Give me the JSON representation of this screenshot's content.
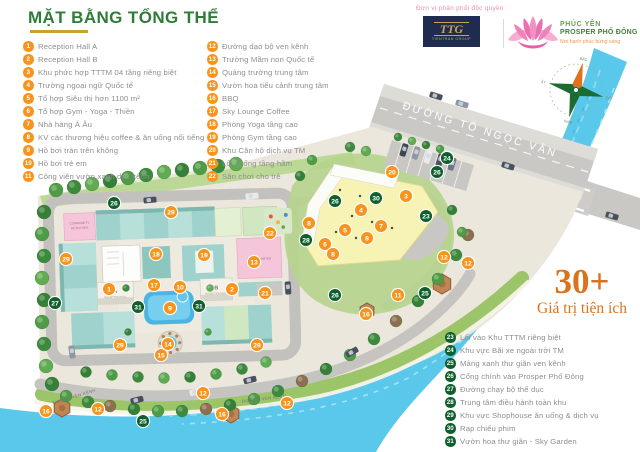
{
  "title": {
    "text": "MẶT BẰNG TỔNG THỂ"
  },
  "colors": {
    "title_green": "#2f7c38",
    "gold": "#c9a22e",
    "badge_orange": "#f7941e",
    "badge_green": "#0e5f2c",
    "legend_text": "#8e8e8e",
    "river": "#5ac8ea",
    "road": "#c9c8c4",
    "platform": "#ebe7dc",
    "highlight_orange": "#d9731c"
  },
  "legend": {
    "group1": [
      {
        "n": "1",
        "label": "Reception Hall  A"
      },
      {
        "n": "2",
        "label": "Reception Hall B"
      },
      {
        "n": "3",
        "label": "Khu phức hợp TTTM 04 tầng riêng biệt"
      },
      {
        "n": "4",
        "label": "Trường ngoại ngữ Quốc tế"
      },
      {
        "n": "5",
        "label": "Tổ hợp Siêu thị hơn 1100 m²"
      },
      {
        "n": "6",
        "label": "Tổ hợp Gym - Yoga - Thiền"
      },
      {
        "n": "7",
        "label": "Nhà hàng Á Âu"
      },
      {
        "n": "8",
        "label": "KV các thương hiệu coffee & ăn uống nổi tiếng"
      },
      {
        "n": "9",
        "label": "Hồ bơi tràn trên không"
      },
      {
        "n": "10",
        "label": "Hồ bơi trẻ em"
      },
      {
        "n": "11",
        "label": "Công viên vườn xanh dọc kênh"
      }
    ],
    "group2": [
      {
        "n": "12",
        "label": "Đường dạo bộ ven kênh"
      },
      {
        "n": "13",
        "label": "Trường Mầm non Quốc tế"
      },
      {
        "n": "14",
        "label": "Quảng trường trung tâm"
      },
      {
        "n": "15",
        "label": "Vườn hoa tiểu cảnh trung tâm"
      },
      {
        "n": "16",
        "label": "BBQ"
      },
      {
        "n": "17",
        "label": "Sky Lounge Coffee"
      },
      {
        "n": "18",
        "label": "Phòng Yoga tầng cao"
      },
      {
        "n": "19",
        "label": "Phòng Gym tầng cao"
      },
      {
        "n": "20",
        "label": "Khu Căn hộ dịch vụ TM"
      },
      {
        "n": "21",
        "label": "Lối xuống tầng hầm"
      },
      {
        "n": "22",
        "label": "Sân chơi cho trẻ"
      }
    ],
    "group3": [
      {
        "n": "23",
        "label": "Lối vào Khu TTTM riêng biệt"
      },
      {
        "n": "24",
        "label": "Khu vực Bãi xe ngoài trời TM"
      },
      {
        "n": "25",
        "label": "Mảng xanh thư giãn ven kênh"
      },
      {
        "n": "26",
        "label": "Cổng chính vào Prosper Phố Đông"
      },
      {
        "n": "27",
        "label": "Đường chạy bộ thể dục"
      },
      {
        "n": "28",
        "label": "Trung tâm điều hành toàn khu"
      },
      {
        "n": "29",
        "label": "Khu vực Shophouse ăn uống & dịch vụ"
      },
      {
        "n": "30",
        "label": "Rạp chiếu phim"
      },
      {
        "n": "31",
        "label": "Vườn hoa thư giãn - Sky Garden"
      }
    ]
  },
  "distributor": {
    "heading": "Đơn vị phân phối độc quyền",
    "ttg_monogram": "TTG",
    "ttg_name": "TIENTRAN GROUP",
    "brand_line1": "PHÚC YÊN",
    "brand_line2": "PROSPER PHỐ ĐÔNG",
    "brand_tagline": "Nơi hạnh phúc bừng sáng"
  },
  "highlight": {
    "big": "30+",
    "sub": "Giá trị tiện ích"
  },
  "compass": {
    "north": "BẮC",
    "east": "ĐÔNG",
    "south": "NAM",
    "west": "TÂY"
  },
  "map": {
    "road_main": "ĐƯỜNG TÔ NGỌC VÂN",
    "road_canal": "ĐƯỜNG VEN KÊNH",
    "labels": {
      "community_1": "COMMUNITY",
      "community_2": "ACTIVITIES",
      "kindergarten": "KINDERGARTEN",
      "reception_a": "A",
      "reception_a_sub": "RECEPTION HALL",
      "reception_b": "B",
      "reception_b_sub": "RECEPTION HALL"
    },
    "markers": [
      {
        "n": "26",
        "x": 114,
        "y": 203,
        "c": "g"
      },
      {
        "n": "29",
        "x": 171,
        "y": 212,
        "c": "o"
      },
      {
        "n": "18",
        "x": 156,
        "y": 254,
        "c": "o"
      },
      {
        "n": "19",
        "x": 204,
        "y": 255,
        "c": "o"
      },
      {
        "n": "13",
        "x": 254,
        "y": 262,
        "c": "o"
      },
      {
        "n": "22",
        "x": 270,
        "y": 233,
        "c": "o"
      },
      {
        "n": "8",
        "x": 309,
        "y": 223,
        "c": "o"
      },
      {
        "n": "28",
        "x": 306,
        "y": 240,
        "c": "g"
      },
      {
        "n": "29",
        "x": 66,
        "y": 259,
        "c": "o"
      },
      {
        "n": "27",
        "x": 55,
        "y": 303,
        "c": "g"
      },
      {
        "n": "1",
        "x": 109,
        "y": 289,
        "c": "o"
      },
      {
        "n": "17",
        "x": 154,
        "y": 285,
        "c": "o"
      },
      {
        "n": "10",
        "x": 180,
        "y": 287,
        "c": "o"
      },
      {
        "n": "2",
        "x": 232,
        "y": 289,
        "c": "o"
      },
      {
        "n": "21",
        "x": 265,
        "y": 293,
        "c": "o"
      },
      {
        "n": "31",
        "x": 138,
        "y": 307,
        "c": "g"
      },
      {
        "n": "9",
        "x": 170,
        "y": 308,
        "c": "o"
      },
      {
        "n": "31",
        "x": 199,
        "y": 306,
        "c": "g"
      },
      {
        "n": "14",
        "x": 168,
        "y": 344,
        "c": "o"
      },
      {
        "n": "15",
        "x": 161,
        "y": 355,
        "c": "o"
      },
      {
        "n": "29",
        "x": 120,
        "y": 345,
        "c": "o"
      },
      {
        "n": "29",
        "x": 257,
        "y": 345,
        "c": "o"
      },
      {
        "n": "24",
        "x": 447,
        "y": 158,
        "c": "g"
      },
      {
        "n": "26",
        "x": 437,
        "y": 172,
        "c": "g"
      },
      {
        "n": "20",
        "x": 392,
        "y": 172,
        "c": "o"
      },
      {
        "n": "30",
        "x": 376,
        "y": 198,
        "c": "g"
      },
      {
        "n": "3",
        "x": 406,
        "y": 196,
        "c": "o"
      },
      {
        "n": "4",
        "x": 361,
        "y": 210,
        "c": "o"
      },
      {
        "n": "23",
        "x": 426,
        "y": 216,
        "c": "g"
      },
      {
        "n": "26",
        "x": 335,
        "y": 201,
        "c": "g"
      },
      {
        "n": "5",
        "x": 345,
        "y": 230,
        "c": "o"
      },
      {
        "n": "7",
        "x": 381,
        "y": 226,
        "c": "o"
      },
      {
        "n": "8",
        "x": 367,
        "y": 238,
        "c": "o"
      },
      {
        "n": "6",
        "x": 325,
        "y": 244,
        "c": "o"
      },
      {
        "n": "8",
        "x": 333,
        "y": 254,
        "c": "o"
      },
      {
        "n": "12",
        "x": 444,
        "y": 257,
        "c": "o"
      },
      {
        "n": "12",
        "x": 468,
        "y": 263,
        "c": "o"
      },
      {
        "n": "11",
        "x": 398,
        "y": 295,
        "c": "o"
      },
      {
        "n": "25",
        "x": 425,
        "y": 293,
        "c": "g"
      },
      {
        "n": "16",
        "x": 366,
        "y": 314,
        "c": "o"
      },
      {
        "n": "26",
        "x": 335,
        "y": 295,
        "c": "g"
      },
      {
        "n": "16",
        "x": 46,
        "y": 411,
        "c": "o"
      },
      {
        "n": "12",
        "x": 98,
        "y": 409,
        "c": "o"
      },
      {
        "n": "25",
        "x": 143,
        "y": 421,
        "c": "g"
      },
      {
        "n": "12",
        "x": 203,
        "y": 393,
        "c": "o"
      },
      {
        "n": "16",
        "x": 222,
        "y": 414,
        "c": "o"
      },
      {
        "n": "12",
        "x": 287,
        "y": 403,
        "c": "o"
      }
    ]
  }
}
